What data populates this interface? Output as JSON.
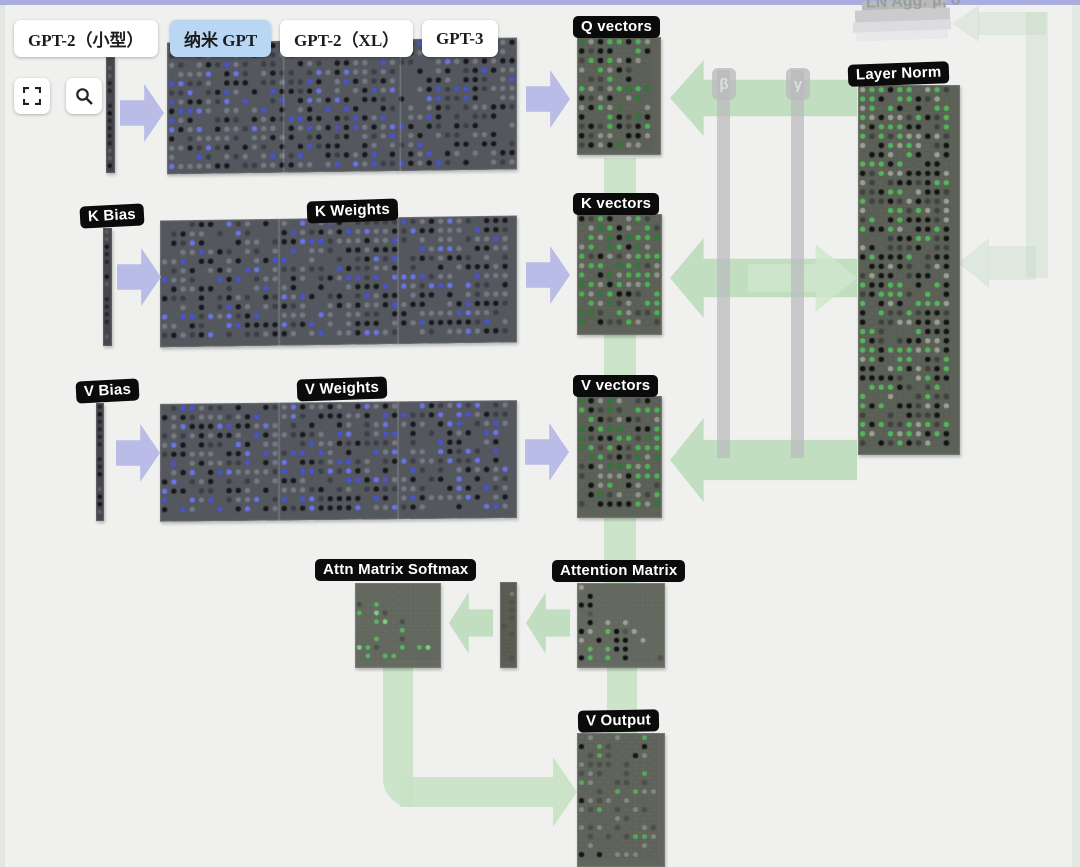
{
  "toolbar": {
    "buttons": [
      {
        "label": "GPT-2（小型）"
      },
      {
        "label": "纳米 GPT"
      },
      {
        "label": "GPT-2（XL）"
      },
      {
        "label": "GPT-3"
      }
    ],
    "selected": "纳米 GPT"
  },
  "labels": {
    "q_vectors": "Q vectors",
    "k_bias": "K Bias",
    "k_weights": "K Weights",
    "k_vectors": "K vectors",
    "v_bias": "V Bias",
    "v_weights": "V Weights",
    "v_vectors": "V vectors",
    "layer_norm": "Layer Norm",
    "attn_softmax": "Attn Matrix Softmax",
    "attention_matrix": "Attention Matrix",
    "v_output": "V Output",
    "ln_agg": "LN Agg: μ, σ"
  },
  "pillars": {
    "beta": "β",
    "gamma": "γ"
  },
  "colors": {
    "background": "#f0f1ef",
    "top_strip": "#a9aede",
    "selected_button": "#b9d6f3",
    "purple_arrow": "#b8bce6",
    "green_arrow": "#bedcbc",
    "label_bg": "#0b0b0b",
    "label_text": "#ffffff"
  },
  "palettes": {
    "weights": {
      "bg": "#54575e",
      "cell": 9.2,
      "fill": 0.78,
      "grid": false,
      "colors": [
        [
          "#17191d",
          0.3
        ],
        [
          "#3c3f46",
          0.2
        ],
        [
          "#767983",
          0.28
        ],
        [
          "#4853cf",
          0.14
        ],
        [
          "#6a74e8",
          0.08
        ]
      ]
    },
    "vectors": {
      "bg": "#5e635a",
      "cell": 9.4,
      "fill": 0.8,
      "grid": true,
      "colors": [
        [
          "#4fb054",
          0.26
        ],
        [
          "#2f7a36",
          0.12
        ],
        [
          "#131512",
          0.26
        ],
        [
          "#43463f",
          0.16
        ],
        [
          "#8f938a",
          0.2
        ]
      ]
    },
    "layernorm": {
      "bg": "#5d6259",
      "cell": 9.3,
      "fill": 0.85,
      "grid": true,
      "colors": [
        [
          "#54b65a",
          0.33
        ],
        [
          "#121411",
          0.3
        ],
        [
          "#3f423c",
          0.17
        ],
        [
          "#9aa092",
          0.2
        ]
      ]
    },
    "softmax": {
      "bg": "#666b62",
      "cell": 8.6,
      "fill": 0.45,
      "grid": true,
      "tri": true,
      "colors": [
        [
          "#58b75e",
          0.55
        ],
        [
          "#7fd084",
          0.2
        ],
        [
          "#4c5048",
          0.25
        ]
      ]
    },
    "attention": {
      "bg": "#666b62",
      "cell": 8.8,
      "fill": 0.62,
      "grid": true,
      "tri": true,
      "cluster": "#101210",
      "colors": [
        [
          "#101210",
          0.34
        ],
        [
          "#58b75e",
          0.26
        ],
        [
          "#505449",
          0.2
        ],
        [
          "#9aa092",
          0.2
        ]
      ]
    },
    "voutput": {
      "bg": "#61655d",
      "cell": 9.0,
      "fill": 0.5,
      "grid": true,
      "colors": [
        [
          "#4b4f47",
          0.4
        ],
        [
          "#83887e",
          0.35
        ],
        [
          "#57a95c",
          0.12
        ],
        [
          "#151714",
          0.13
        ]
      ]
    },
    "bias": {
      "bg": "#44464c",
      "cell": 7.5,
      "fill": 0.85,
      "grid": false,
      "colors": [
        [
          "#26282c",
          0.5
        ],
        [
          "#5a5d64",
          0.3
        ],
        [
          "#15161a",
          0.2
        ]
      ]
    },
    "strip": {
      "bg": "#5a5e55",
      "cell": 8.0,
      "fill": 0.5,
      "grid": true,
      "first": "#c99a4e",
      "colors": [
        [
          "#4e5249",
          0.6
        ],
        [
          "#777b71",
          0.4
        ]
      ]
    }
  },
  "matrices": [
    {
      "name": "q-weights-matrix",
      "type": "weights",
      "x": 167,
      "y": 40,
      "w": 350,
      "h": 132,
      "seed": 11,
      "seams": true,
      "skew": -0.8
    },
    {
      "name": "k-weights-matrix",
      "type": "weights",
      "x": 160,
      "y": 218,
      "w": 357,
      "h": 127,
      "seed": 22,
      "seams": true,
      "skew": -0.8
    },
    {
      "name": "v-weights-matrix",
      "type": "weights",
      "x": 160,
      "y": 402,
      "w": 357,
      "h": 118,
      "seed": 33,
      "seams": true,
      "skew": -0.6
    },
    {
      "name": "q-bias-column",
      "type": "bias",
      "x": 106,
      "y": 57,
      "w": 9,
      "h": 116,
      "seed": 41
    },
    {
      "name": "k-bias-column",
      "type": "bias",
      "x": 103,
      "y": 228,
      "w": 9,
      "h": 118,
      "seed": 42
    },
    {
      "name": "v-bias-column",
      "type": "bias",
      "x": 96,
      "y": 403,
      "w": 8,
      "h": 118,
      "seed": 43
    },
    {
      "name": "q-vectors-matrix",
      "type": "vectors",
      "x": 577,
      "y": 37,
      "w": 84,
      "h": 118,
      "seed": 51
    },
    {
      "name": "k-vectors-matrix",
      "type": "vectors",
      "x": 577,
      "y": 214,
      "w": 85,
      "h": 121,
      "seed": 52
    },
    {
      "name": "v-vectors-matrix",
      "type": "vectors",
      "x": 577,
      "y": 396,
      "w": 85,
      "h": 122,
      "seed": 53
    },
    {
      "name": "layer-norm-matrix",
      "type": "layernorm",
      "x": 858,
      "y": 85,
      "w": 102,
      "h": 370,
      "seed": 61
    },
    {
      "name": "attn-softmax-matrix",
      "type": "softmax",
      "x": 355,
      "y": 583,
      "w": 86,
      "h": 85,
      "seed": 71
    },
    {
      "name": "attn-strip-matrix",
      "type": "strip",
      "x": 500,
      "y": 582,
      "w": 17,
      "h": 86,
      "seed": 72
    },
    {
      "name": "attention-matrix",
      "type": "attention",
      "x": 577,
      "y": 583,
      "w": 88,
      "h": 85,
      "seed": 73
    },
    {
      "name": "v-output-matrix",
      "type": "voutput",
      "x": 577,
      "y": 733,
      "w": 88,
      "h": 134,
      "seed": 81
    }
  ]
}
